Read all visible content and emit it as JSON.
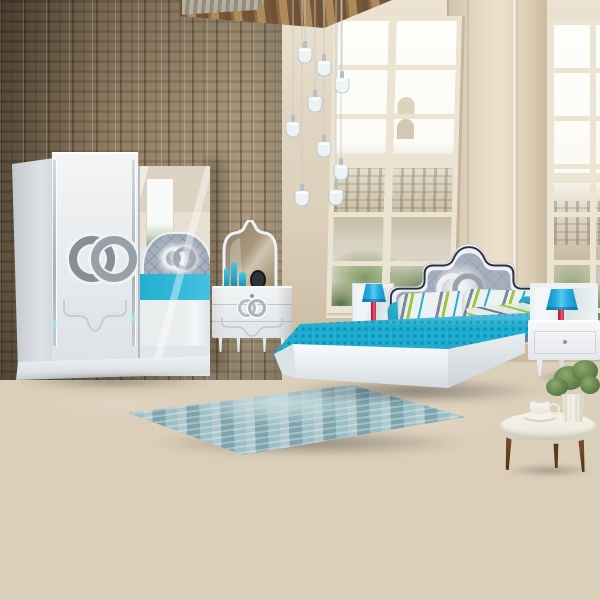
{
  "scene": {
    "objects": [
      {
        "name": "wood-accent-wall",
        "label": "rustic wood plank wall"
      },
      {
        "name": "tall-windows",
        "label": "two tall paned windows with trees and buildings outside"
      },
      {
        "name": "pendant-light-cluster",
        "label": "nine glass pendant lamps on cables"
      },
      {
        "name": "sliding-wardrobe",
        "label": "white wardrobe, one mirror door, interlocking-rings emblem"
      },
      {
        "name": "dresser-with-mirror",
        "label": "white three-drawer dresser with arched mirror and turquoise decor"
      },
      {
        "name": "double-bed",
        "label": "white bed, gray tufted headboard with glowing rings emblem, turquoise bedding"
      },
      {
        "name": "nightstands",
        "label": "two white nightstands with blue-shade red-stem lamps"
      },
      {
        "name": "area-rug",
        "label": "distressed teal rug on dark concrete floor"
      },
      {
        "name": "coffee-table",
        "label": "round white table, wooden legs, teacup and potted plant"
      }
    ],
    "pendant_count": 9
  },
  "colors": {
    "wood_dark": "#5e4d38",
    "wood_mid": "#87745a",
    "wood_light": "#b1a083",
    "wall_beige": "#dccfba",
    "wall_beige_light": "#ece2d1",
    "wall_beige_dark": "#c8b99f",
    "ceiling_brown": "#6f5233",
    "ceiling_tan": "#b08a5c",
    "window_frame": "#ece4d3",
    "sky_white": "#fdfdfa",
    "building_tan": "#d5c9b6",
    "tree_green": "#7d9a62",
    "tree_green_dark": "#5d7a47",
    "white_furniture": "#eff1f3",
    "white_shadow": "#ccd2d7",
    "chrome_silver": "#b3bac1",
    "emblem_gray": "#878f96",
    "headboard_gray": "#a5afbc",
    "headboard_line": "#8893a2",
    "trim_black": "#2c3138",
    "turquoise": "#1fadd1",
    "turquoise_dark": "#0e8fb4",
    "turquoise_light": "#4cc6e6",
    "blanket_gray": "#75808f",
    "pillow_white": "#eef1f2",
    "lime_green": "#9cc83f",
    "lamp_blue": "#28a9e0",
    "lamp_red": "#cf2848",
    "rug_teal": "#9cbfc6",
    "rug_light": "#c9dcdf",
    "rug_dark": "#7da4ad",
    "floor_light": "#7b776f",
    "floor_mid": "#615d57",
    "floor_dark": "#4b4845",
    "table_cream": "#f0eee2",
    "wood_leg": "#744a28",
    "plant_green": "#627f4a",
    "glow_cyan": "#9fe8f0"
  }
}
